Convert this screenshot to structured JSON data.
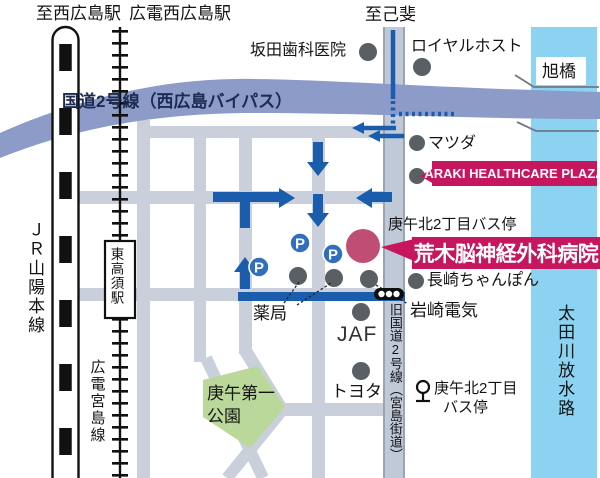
{
  "colors": {
    "street": "#c9d0db",
    "bypass_band": "#8c9bc8",
    "river": "#8bd3f0",
    "route_blue": "#1b5dad",
    "banner_crimson": "#c6165e",
    "hospital_circle": "#c04e74",
    "park_green": "#b9d89a",
    "dot_gray": "#595f63",
    "parking_blue": "#2f6fbc"
  },
  "labels": {
    "to_nishi_hiroshima": "至西広島駅",
    "hiroden_nishi_hiroshima": "広電西広島駅",
    "to_koi": "至己斐",
    "sakata_dental": "坂田歯科医院",
    "royal_host": "ロイヤルホスト",
    "asahi_bridge": "旭橋",
    "route2_bypass": "国道2号線（西広島バイパス）",
    "matsuda": "マツダ",
    "araki_plaza": "ARAKI HEALTHCARE PLAZA",
    "busstop_north": "庚午北2丁目バス停",
    "hospital": "荒木脳神経外科病院",
    "jr_sanyo_line": "ＪＲ山陽本線",
    "higashi_takasu_station": "東高須駅",
    "hiroden_miyajima_line": "広電宮島線",
    "pharmacy": "薬局",
    "jaf": "JAF",
    "nagasaki_chanpon": "長崎ちゃんぽん",
    "iwasaki_denki": "岩崎電気",
    "old_route2": "旧国道2号線（宮島街道）",
    "toyota": "トヨタ",
    "park_line1": "庚午第一",
    "park_line2": "公園",
    "busstop_south_line1": "庚午北2丁目",
    "busstop_south_line2": "バス停",
    "ota_river": "太田川放水路",
    "parking_mark": "P"
  }
}
